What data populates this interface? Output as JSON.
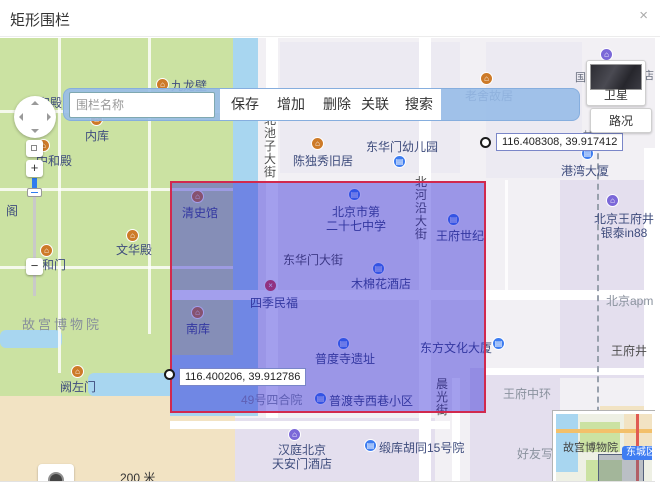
{
  "modal": {
    "title": "矩形围栏",
    "close_glyph": "×"
  },
  "toolbar": {
    "input_placeholder": "围栏名称",
    "buttons": [
      "保存",
      "增加",
      "删除",
      "关联",
      "搜索"
    ]
  },
  "fence": {
    "fill_color": "#241ad4",
    "border_color": "#d1294e",
    "corner_labels": [
      {
        "text": "116.408308, 39.917412"
      },
      {
        "text": "116.400206, 39.912786"
      }
    ]
  },
  "map": {
    "controls": {
      "zoom_in": "+",
      "zoom_out": "−"
    },
    "layers": {
      "satellite": "卫星",
      "traffic": "路况"
    },
    "scale": {
      "text": "200 米"
    },
    "copyright": {
      "logo_text": "高德地图",
      "license": "© 2022 AutoNavi - GS(2021)6375号"
    },
    "minimap": {
      "area_label": "故宫博物院",
      "district_badge": "东城区",
      "gov_label": "市人民政府",
      "star_glyph": "★",
      "collapse_glyph": "↘"
    },
    "pois": [
      {
        "name": "九龙壁"
      },
      {
        "name": "内库"
      },
      {
        "name": "保和殿"
      },
      {
        "name": "中和殿"
      },
      {
        "name": "阁"
      },
      {
        "name": "太和门"
      },
      {
        "name": "文华殿"
      },
      {
        "name": "清史馆"
      },
      {
        "name": "故宫博物院"
      },
      {
        "name": "阙左门"
      },
      {
        "name": "南库"
      },
      {
        "name": "陈独秀旧居"
      },
      {
        "name": "东华门幼儿园"
      },
      {
        "name": "北京市第\n二十七中学"
      },
      {
        "name": "王府世纪"
      },
      {
        "name": "东华门大街"
      },
      {
        "name": "木棉花酒店"
      },
      {
        "name": "四季民福"
      },
      {
        "name": "普度寺遗址"
      },
      {
        "name": "东方文化大厦"
      },
      {
        "name": "港湾大厦"
      },
      {
        "name": "北京王府井\n银泰in88"
      },
      {
        "name": "北京apm"
      },
      {
        "name": "王府井"
      },
      {
        "name": "王府中环"
      },
      {
        "name": "好友写"
      },
      {
        "name": "49号四合院"
      },
      {
        "name": "普渡寺西巷小区"
      },
      {
        "name": "缎库胡同15号院"
      },
      {
        "name": "汉庭北京\n天安门酒店"
      },
      {
        "name": "老舍故居"
      },
      {
        "name": "甘雨胡同"
      },
      {
        "name": "国"
      },
      {
        "name": "店"
      },
      {
        "name": "晨光街"
      },
      {
        "name": "北池子大街"
      },
      {
        "name": "北河沿大街"
      }
    ]
  }
}
